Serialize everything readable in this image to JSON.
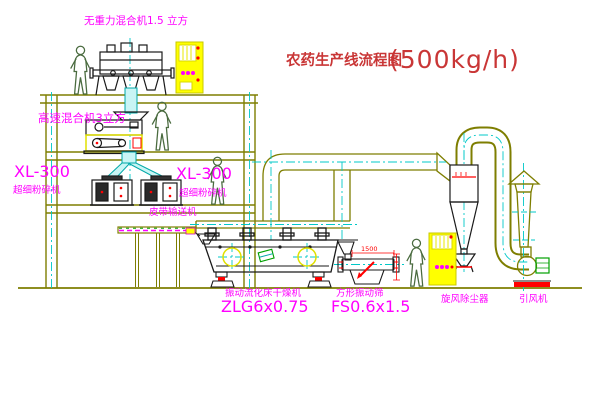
{
  "diagram": {
    "title": "农药生产线流程图",
    "title_capacity": "(500kg/h)"
  },
  "equipment_labels": {
    "gravity_free_mixer": "无重力混合机1.5 立方",
    "high_speed_mixer": "高速混合机3立方",
    "pulverizer_left_model": "XL-300",
    "pulverizer_left_name": "超细粉碎机",
    "pulverizer_center_model": "XL-300",
    "pulverizer_center_name": "超细粉碎机",
    "belt_conveyor": "皮带输送机",
    "fluid_bed_dryer_name": "振动流化床干燥机",
    "fluid_bed_dryer_model": "ZLG6x0.75",
    "square_vibrating_sieve_name": "方形振动筛",
    "square_vibrating_sieve_model": "FS0.6x1.5",
    "cyclone_dust_collector": "旋风除尘器",
    "induced_draft_fan": "引风机"
  },
  "dimensions": {
    "sieve_length": "1500"
  },
  "colors": {
    "label_magenta": "#ff00ff",
    "title_red": "#c93636",
    "structure_olive": "#7e7e00",
    "centerline_cyan": "#00c8c8",
    "machine_black": "#1a1a1a",
    "duct_fill_cyan": "#c9f5f5",
    "highlight_yellow": "#ffff00",
    "alert_red": "#ff0000",
    "person_green": "#4a6b3f",
    "conveyor_green": "#00a000"
  }
}
